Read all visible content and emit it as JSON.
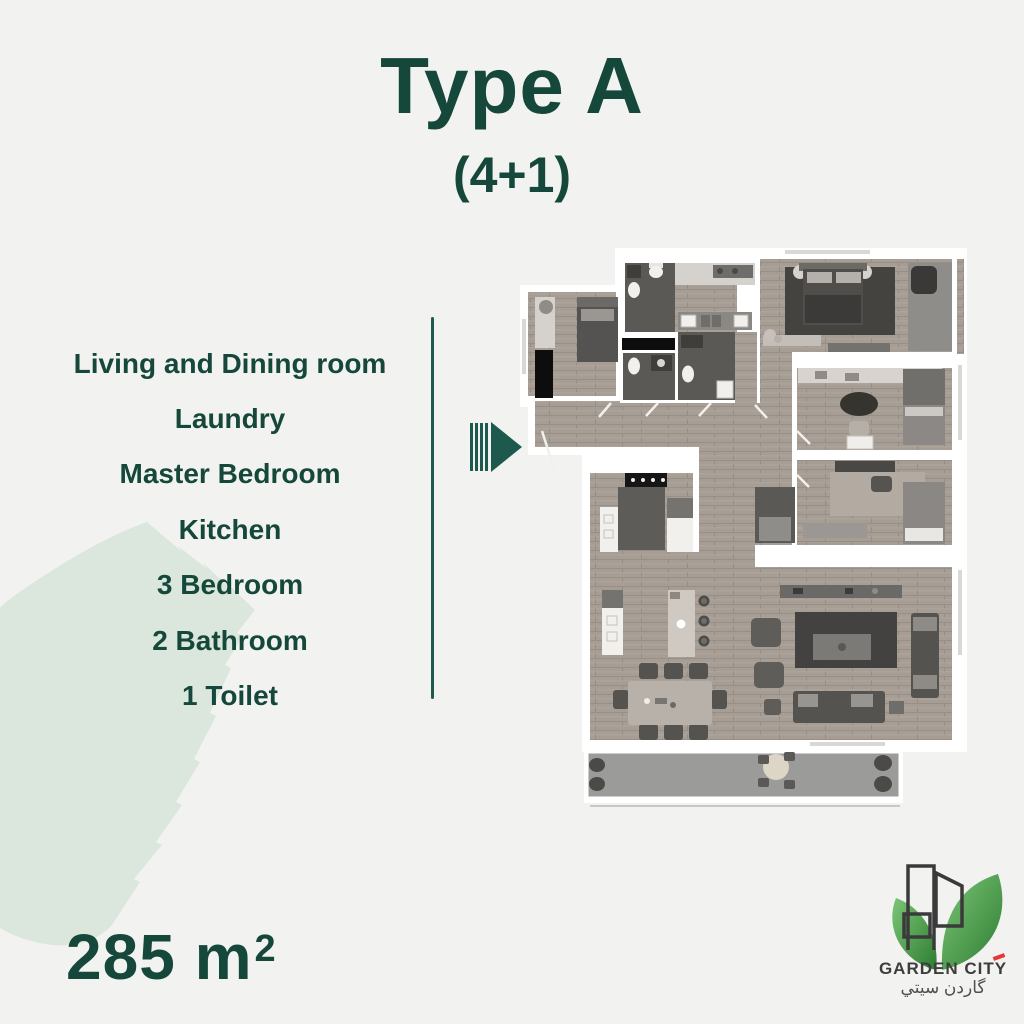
{
  "page": {
    "background": "#f2f3f1",
    "accent_green": "#15483b",
    "divider_teal": "#1e5b4e",
    "leaf_tint": "#dbe7dc"
  },
  "title": {
    "text": "Type A",
    "subtitle": "(4+1)"
  },
  "features": {
    "items": [
      "Living and Dining room",
      "Laundry",
      "Master Bedroom",
      "Kitchen",
      "3 Bedroom",
      "2 Bathroom",
      "1 Toilet"
    ]
  },
  "area": {
    "value": "285",
    "unit": "m",
    "superscript": "2"
  },
  "arrow_icon": {
    "meaning": "entrance-direction",
    "color": "#1d5a4d"
  },
  "floor_plan": {
    "type": "3d-top-down-render",
    "rooms": [
      "laundry",
      "bathroom",
      "bathroom",
      "toilet",
      "hallway",
      "master-bedroom",
      "walk-in-closet",
      "bedroom",
      "bedroom",
      "kitchen",
      "dining-area",
      "living-room",
      "balcony"
    ],
    "colors": {
      "walls": "#ffffff",
      "wood_floor": "#a69d95",
      "wet_floor": "#5b5956",
      "balcony_floor": "#9b9b99",
      "rug_dark": "#434240"
    }
  },
  "logo": {
    "name": "GARDEN CITY",
    "name_ar": "گاردن سيتي",
    "text_color": "#3d3d3d",
    "accent_red": "#e53935",
    "leaf_green_light": "#7cc576",
    "leaf_green_dark": "#2e7d32",
    "building_outline": "#3a3a3a"
  }
}
